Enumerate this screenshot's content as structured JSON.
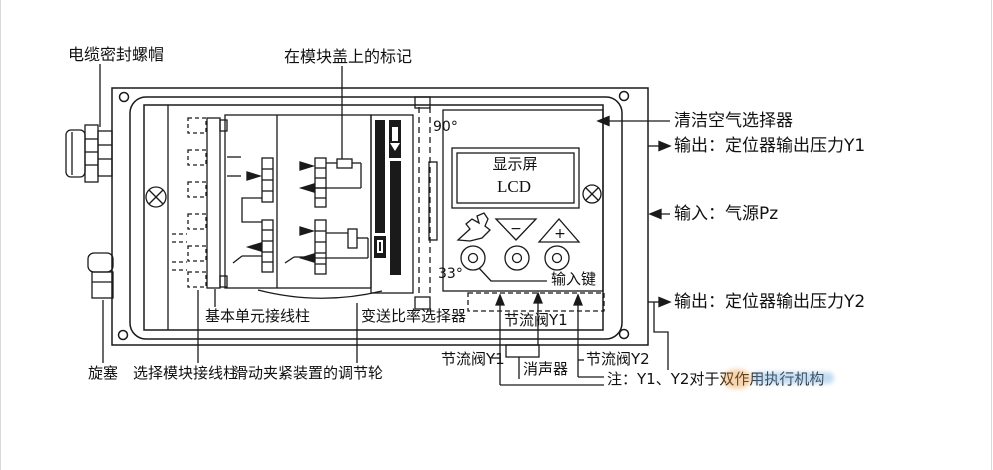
{
  "title": "阀门定位器面板示意图",
  "colors": {
    "line": "#1a1a1a",
    "background": "#ffffff",
    "watermark_orange": "#e8953a",
    "watermark_blue": "#7fb3e0"
  },
  "labels": {
    "cable_gland": "电缆密封螺帽",
    "module_mark": "在模块盖上的标记",
    "angle_90": "90°",
    "angle_33": "33°",
    "input_key": "输入键",
    "clean_air": "清洁空气选择器",
    "output_y1": "输出：定位器输出压力Y1",
    "input_pz": "输入：气源Pz",
    "output_y2": "输出：定位器输出压力Y2",
    "basic_unit_terminal": "基本单元接线柱",
    "ratio_selector": "变送比率选择器",
    "throttle_y1_inner": "节流阀Y1",
    "throttle_y1": "节流阀Y1",
    "muffler": "消声器",
    "throttle_y2": "节流阀Y2",
    "note": "注：Y1、Y2对于双作用执行机构",
    "plug": "旋塞",
    "select_module_terminal": "选择模块接线柱",
    "slide_clamp_wheel": "滑动夹紧装置的调节轮",
    "minus": "−",
    "plus": "+"
  },
  "display": {
    "line1": "显示屏",
    "line2": "LCD"
  }
}
